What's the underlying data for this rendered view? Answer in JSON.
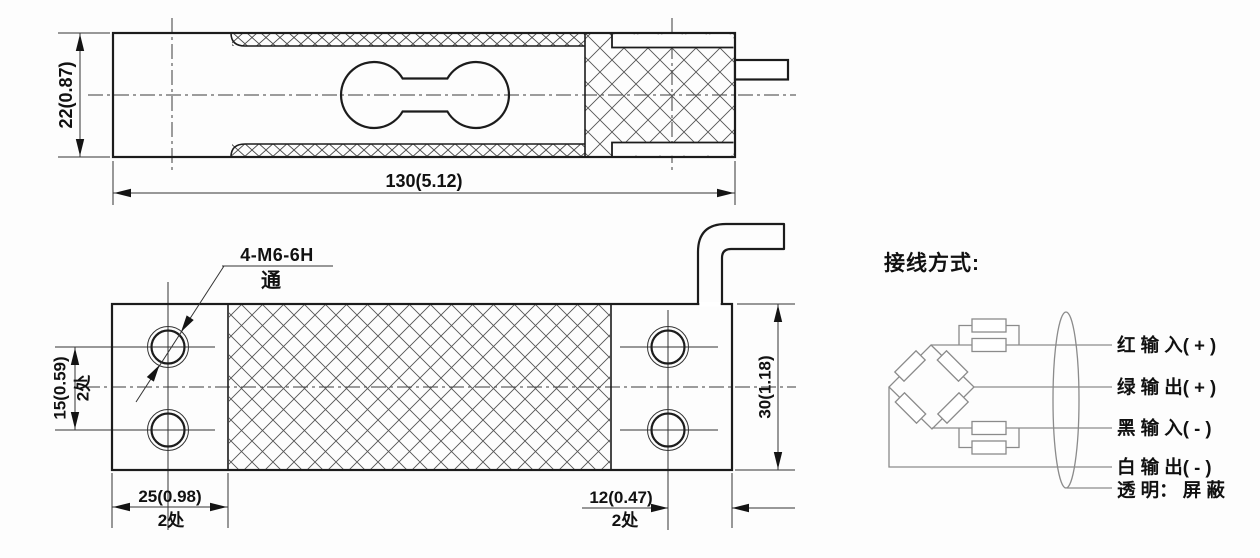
{
  "top_view": {
    "height_dim": "22(0.87)",
    "length_dim": "130(5.12)"
  },
  "plan_view": {
    "thread_callout": "4-M6-6H",
    "thread_through_note": "通",
    "hole_pitch_dim": "15(0.59)",
    "hole_pitch_places": "2处",
    "width_dim": "30(1.18)",
    "left_end_dim": "25(0.98)",
    "left_end_places": "2处",
    "right_end_dim": "12(0.47)",
    "right_end_places": "2处"
  },
  "wiring": {
    "title": "接线方式:",
    "labels": [
      "红 输 入( + )",
      "绿 输 出( + )",
      "黑 输 入( - )",
      "白 输 出( - )",
      "透 明： 屏 蔽"
    ]
  },
  "colors": {
    "outline": "#1c1c1c",
    "circuit": "#8b8b8b",
    "background": "#fdfdfd"
  }
}
